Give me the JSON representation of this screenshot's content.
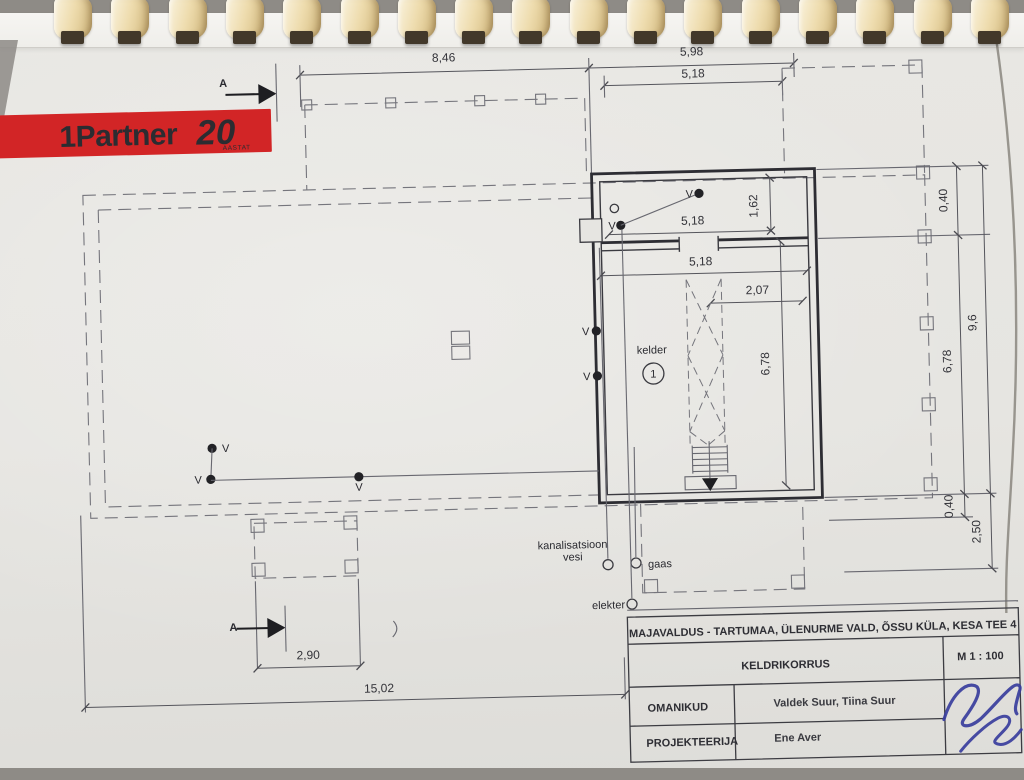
{
  "logo": {
    "brand": "1Partner",
    "years": "20",
    "sub": "AASTAT"
  },
  "plan": {
    "labels": {
      "room": "kelder",
      "room_no": "1",
      "vent": "V",
      "section": "A",
      "sewer": "kanalisatsioon",
      "water": "vesi",
      "gas": "gaas",
      "electricity": "elekter"
    },
    "dims": {
      "top_left": "8,46",
      "top_right": "5,98",
      "top_inner": "5,18",
      "room_top": "5,18",
      "room_height": "1,62",
      "room_mid": "5,18",
      "stair_width": "2,07",
      "room_depth": "6,78",
      "right_offset_top": "0,40",
      "right_total": "9,6",
      "right_depth": "6,78",
      "right_offset_bottom": "0,40",
      "right_terrace": "2,50",
      "porch_width": "2,90",
      "total_width": "15,02"
    }
  },
  "title_block": {
    "address": "MAJAVALDUS - TARTUMAA, ÜLENURME VALD, ÕSSU KÜLA, KESA TEE 4",
    "drawing": "KELDRIKORRUS",
    "scale": "M 1 : 100",
    "owners_label": "OMANIKUD",
    "owners": "Valdek Suur, Tiina Suur",
    "designer_label": "PROJEKTEERIJA",
    "designer": "Ene Aver"
  },
  "colors": {
    "logo_red": "#d22526",
    "signature_blue": "#383d9d",
    "paper": "#e6e5e1",
    "line_gray": "#686870",
    "wall_dark": "#2d2d33"
  }
}
